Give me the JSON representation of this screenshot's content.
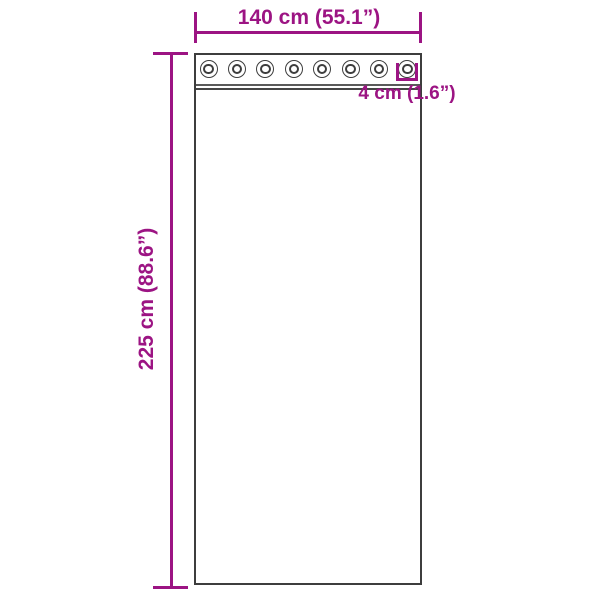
{
  "diagram": {
    "type": "product-dimension-diagram",
    "subject": "curtain-with-grommets",
    "background_color": "#ffffff",
    "accent_color": "#9c1483",
    "outline_color": "#3d3d3d",
    "grommet_count": 8,
    "dimensions": {
      "width": {
        "label": "140 cm (55.1”)",
        "value_cm": 140,
        "value_in": 55.1
      },
      "height": {
        "label": "225 cm (88.6”)",
        "value_cm": 225,
        "value_in": 88.6
      },
      "grommet_diameter": {
        "label": "4 cm (1.6”)",
        "value_cm": 4,
        "value_in": 1.6
      }
    }
  }
}
